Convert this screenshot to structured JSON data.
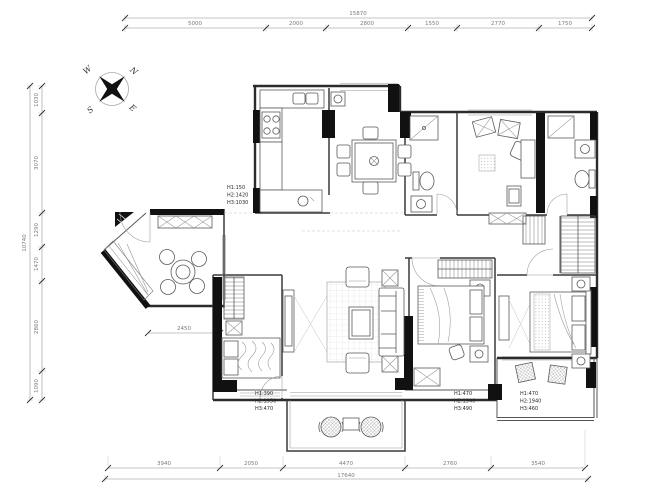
{
  "drawing": {
    "type": "apartment-floor-plan"
  },
  "compass": {
    "north": "N",
    "south": "S",
    "east": "E",
    "west": "W"
  },
  "dimensions": {
    "top": {
      "total": "15870",
      "segments": [
        "5000",
        "2000",
        "2800",
        "1550",
        "2770",
        "1750"
      ]
    },
    "left": {
      "total": "10740",
      "segments": [
        "1030",
        "3070",
        "1290",
        "1470",
        "2860",
        "1090"
      ]
    },
    "bottom": {
      "total": "17640",
      "segments": [
        "3940",
        "2050",
        "4470",
        "2760",
        "3540"
      ]
    },
    "inner": {
      "balcony": "2450"
    }
  },
  "annotations": {
    "kitchen_window": {
      "line1": "H1:150",
      "line2": "H2:1420",
      "line3": "H3:1030"
    },
    "bedroom1_window": {
      "line1": "H1:390",
      "line2": "H2:1950",
      "line3": "H3:470"
    },
    "bedroom2_window": {
      "line1": "H1:470",
      "line2": "H2:1940",
      "line3": "H3:490"
    },
    "master_window": {
      "line1": "H1:470",
      "line2": "H2:1940",
      "line3": "H3:460"
    }
  },
  "colors": {
    "wall": "#111111",
    "line": "#555555",
    "dim_text": "#7a7a7a"
  }
}
